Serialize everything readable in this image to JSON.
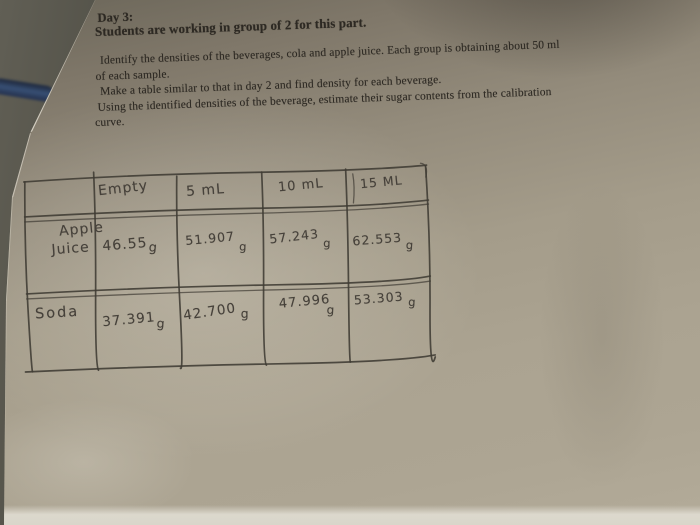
{
  "printed_text": {
    "heading_line1": "Day 3:",
    "heading_line2": "Students are working in group of 2 for this part.",
    "body_lines": [
      "Identify the densities of the beverages, cola and apple juice. Each group is obtaining about 50 ml",
      "of each sample.",
      "Make a table similar to that in day 2 and find density for each beverage.",
      "Using the identified densities of the beverage, estimate their sugar contents from the calibration",
      "curve."
    ]
  },
  "handwritten_table": {
    "unit": "g",
    "column_headers": [
      "Empty",
      "5 mL",
      "10 mL",
      "15 ML"
    ],
    "rows": [
      {
        "label_lines": [
          "Apple",
          "Juice"
        ],
        "values": [
          "46.55",
          "51.907",
          "57.243",
          "62.553"
        ]
      },
      {
        "label_lines": [
          "Soda"
        ],
        "values": [
          "37.391",
          "42.700",
          "47.996",
          "53.303"
        ]
      }
    ]
  },
  "colors": {
    "desk_surface": "#3d3c34",
    "cable_blue": "#2b3c5c",
    "paper_top": "#6b6659",
    "paper_bottom": "#b3ab99",
    "paper_bottom_strip": "#d9d6ca",
    "printed_ink": "#2d2923",
    "pencil": "#46413a"
  }
}
